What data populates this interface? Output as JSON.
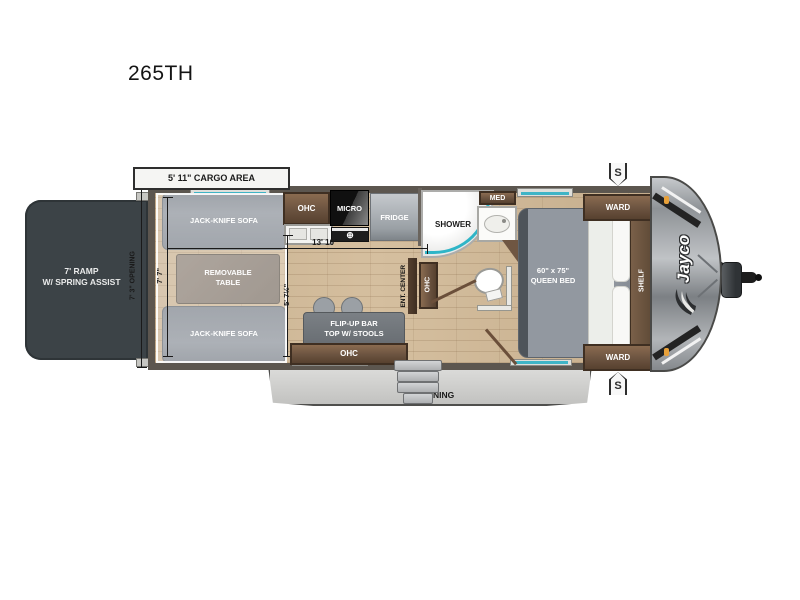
{
  "title": "265TH",
  "annotations": {
    "cargo_area": "5' 11\" CARGO AREA",
    "opening_dim": "7' 3\" OPENING",
    "cargo_height_dim": "7' 7\"",
    "main_length_dim": "13' 10\"",
    "aisle_dim": "5' 7½\"",
    "awning": "16' AWNING",
    "stabilizer_jack": "S"
  },
  "rooms": {
    "ramp": "7' RAMP\nW/ SPRING ASSIST",
    "sofa_front": "JACK-KNIFE SOFA",
    "sofa_rear": "JACK-KNIFE SOFA",
    "table": "REMOVABLE\nTABLE",
    "kitchen_ohc": "OHC",
    "micro": "MICRO",
    "fridge": "FRIDGE",
    "shower": "SHOWER",
    "med": "MED",
    "bath_ohc": "OHC",
    "ent_center": "ENT. CENTER",
    "bar": "FLIP-UP BAR\nTOP W/ STOOLS",
    "bar_ohc": "OHC",
    "bed": "60\" x 75\"\nQUEEN BED",
    "ward_front": "WARD",
    "ward_rear": "WARD",
    "shelf": "SHELF"
  },
  "brand": {
    "logo": "Jayco"
  },
  "icons": {
    "burner": "⊕"
  },
  "colors": {
    "accent_teal": "#2fb5c7",
    "wood": "#6b5340",
    "floor": "#cdb493",
    "ramp": "#3c4347",
    "wall": "#5c564f",
    "awning": "#d2d2d0",
    "marker_orange": "#e8a13a"
  }
}
